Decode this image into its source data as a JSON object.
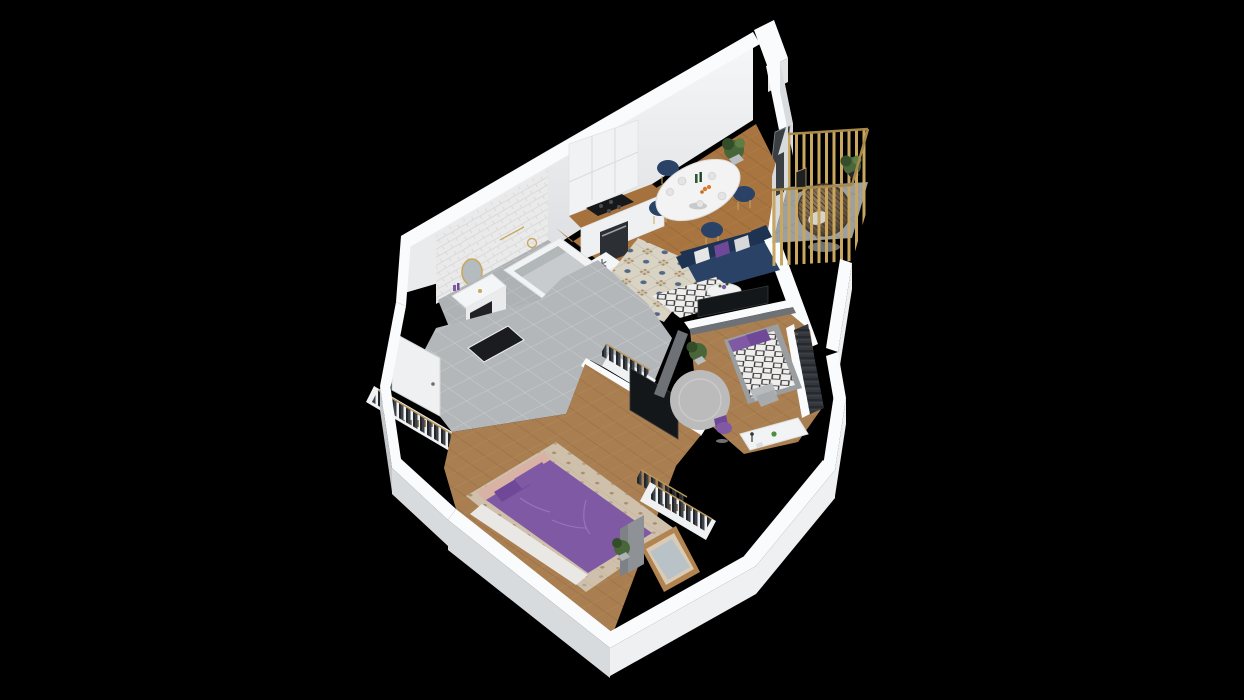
{
  "scene": {
    "title": "3D apartment floor plan render",
    "description": "Isometric dollhouse-style 3D render of a one-bedroom apartment with kids room, bathroom, hallway, open kitchen-living area and a balcony with a hanging egg chair, shown on a black background.",
    "icons": {
      "fridge_top": "snowflake-icon"
    },
    "rooms": [
      {
        "id": "kitchen-dining",
        "label": "Kitchen / Dining",
        "floor": "herringbone wood with patterned tile rug",
        "furniture": [
          "white cabinet run with gold knobs",
          "wood countertop",
          "black cooktop",
          "oven",
          "fridge unit with snowflake symbol",
          "oval white dining table with tableware",
          "four navy dining chairs with gold legs",
          "potted plant"
        ]
      },
      {
        "id": "living",
        "label": "Living Area",
        "floor": "herringbone wood",
        "furniture": [
          "navy two-seater sofa",
          "white and purple cushions",
          "round white coffee table with flowers",
          "black-and-white patterned rug",
          "TV on media wall"
        ]
      },
      {
        "id": "balcony",
        "label": "Balcony",
        "floor": "grey tile",
        "furniture": [
          "gold slat railing",
          "rattan hanging egg chair with cushion",
          "potted plant on stand",
          "black lantern"
        ]
      },
      {
        "id": "bathroom",
        "label": "Bathroom",
        "floor": "grey tile",
        "furniture": [
          "subway tile wall",
          "round gold-framed mirror",
          "white floating vanity with basin",
          "gold faucet",
          "bathtub with gold shower fixture",
          "dark storage nook"
        ]
      },
      {
        "id": "hallway",
        "label": "Entrance Hall",
        "floor": "grey tile",
        "furniture": [
          "front door",
          "open clothes rail",
          "dark storage nook",
          "corridor wardrobe with clothes rail"
        ]
      },
      {
        "id": "bedroom",
        "label": "Master Bedroom",
        "floor": "herringbone wood",
        "furniture": [
          "double bed with purple duvet",
          "blush headboard",
          "purple pillows",
          "white sheet",
          "patterned area rug",
          "wall-mounted TV",
          "clothes rail",
          "wood-framed window",
          "grey curtain",
          "potted plant"
        ]
      },
      {
        "id": "kids-room",
        "label": "Second Bedroom",
        "floor": "herringbone wood",
        "furniture": [
          "day bed with black-and-white bedding",
          "purple pillows",
          "grey pillows",
          "round grey rug",
          "white desk with lamp and parrot figure",
          "purple desk chair",
          "wardrobe with clothes",
          "potted plant"
        ]
      }
    ],
    "palette": {
      "background": "#000000",
      "wallTop": "#fafbfc",
      "wallFaceLight": "#eef0f1",
      "wallFaceMid": "#d8dbdd",
      "wallFaceDark": "#c3c7ca",
      "grayWall": "#6e7276",
      "woodFloor": "#a8743f",
      "woodFloorDark": "#8a5c30",
      "bedroomWood": "#a97e50",
      "tileFloor": "#b4b7b9",
      "tileLine": "#cdd0d1",
      "bathFloor": "#aeb2b4",
      "balconyFloor": "#9aa0a3",
      "balconyLine": "#878d90",
      "rugBase": "#d9d3c4",
      "rugMotif": "#51688a",
      "rugAccent": "#b08d5f",
      "bwRugBase": "#efeeec",
      "bwRugMotif": "#2e3033",
      "navy": "#2a4265",
      "navyDark": "#1d3351",
      "purple": "#8059a4",
      "purpleDark": "#6f4897",
      "pillowWhite": "#e6e6e6",
      "headboard": "#d8b3a5",
      "bedRug": "#cfc0ac",
      "roundRug": "#bbbbbb",
      "gold": "#c9a75f",
      "goldDark": "#a9894b",
      "rattan": "#8a7355",
      "rattanDark": "#4f4434",
      "green": "#49663a",
      "greenDark": "#334d28",
      "counterWood": "#a5713d",
      "black": "#14171a",
      "doorWhite": "#eff0f1",
      "glass": "#b9c2c6",
      "curtain": "#8e9296",
      "clothesDark": "#23262b",
      "clothesMid": "#3d434c",
      "hanger": "#8a6a3f"
    }
  }
}
